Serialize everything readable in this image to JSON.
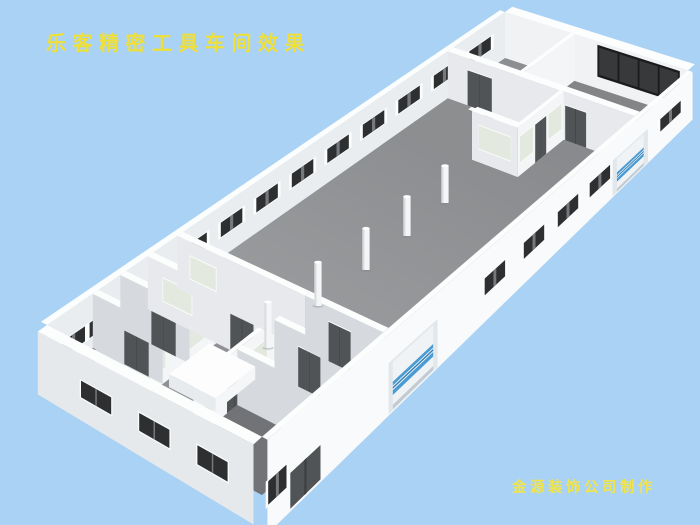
{
  "page": {
    "background": "#a9d2f5"
  },
  "title": {
    "text": "乐客精密工具车间效果",
    "color": "#efdf39"
  },
  "credit": {
    "text": "金源装饰公司制作",
    "color": "#f1e44a"
  },
  "scene": {
    "description": "isometric 3d render of a precision tool workshop interior with open hall, columns, side offices and roll-up doors",
    "palette": {
      "floor_far": "#85878a",
      "floor_near": "#a3a5a7",
      "floor_room_dark": "#717376",
      "floor_room_mid": "#7d7f82",
      "floor_corridor": "#8f9194",
      "floor_restroom": "#adb1b4",
      "floor_right_room": "#838587",
      "floor_left_lower": "#727376",
      "floor_lower_dark": "#686a6d",
      "floor_right_corridor": "#8c8e90",
      "wall_top": "#fcfdfd",
      "wall_interior_far": "#eaedef",
      "wall_interior_ne": "#f0f2f4",
      "wall_partition_se": "#f4f5f7",
      "wall_partition_sw": "#e7e9ec",
      "wall_partition_shadow": "#d6dade",
      "wall_exterior_bright": "#f8fafb",
      "wall_exterior_sw": "#e6e9ec",
      "glass_dark": "#2d2f31",
      "glass_pane": "#37393b",
      "glass_frame": "#fbfcfc",
      "glass_divider": "#75787c",
      "frosted_glass": "#e4e9e0",
      "door_dark": "#515457",
      "door_panel": "#3c3f42",
      "roll_door_body": "#eff3f6",
      "roll_door_stripe": "#4a9bd3",
      "roll_door_stripe_dark": "#2e7cb5",
      "roll_door_bottom": "#c3cbd1",
      "band_frame": "#1a1b1d",
      "column": "#f3f5f6",
      "column_shade": "#d7dbde",
      "column_top": "#ffffff",
      "box_top": "#fdfdfe",
      "box_front": "#f4f6f8",
      "box_side": "#e8ebee",
      "fixture": "#f5f7f8"
    },
    "counts": {
      "columns": 5,
      "nw_wall_windows": 9,
      "nw_wall_low_windows": 2,
      "ne_wall_window_panes": 4,
      "se_wall_windows": 5,
      "sw_wall_windows": 3,
      "roll_up_doors": 2
    },
    "columns_px": [
      [
        268,
        348
      ],
      [
        318,
        306
      ],
      [
        366,
        270
      ],
      [
        407,
        236
      ],
      [
        445,
        203
      ]
    ],
    "se_window_centers": [
      0.535,
      0.627,
      0.707,
      0.782,
      0.948
    ],
    "sw_window_centers": [
      0.27,
      0.54,
      0.81
    ],
    "fixtures_ab": [
      [
        0.025,
        0.2
      ],
      [
        0.05,
        0.255
      ],
      [
        0.075,
        0.3
      ]
    ]
  }
}
